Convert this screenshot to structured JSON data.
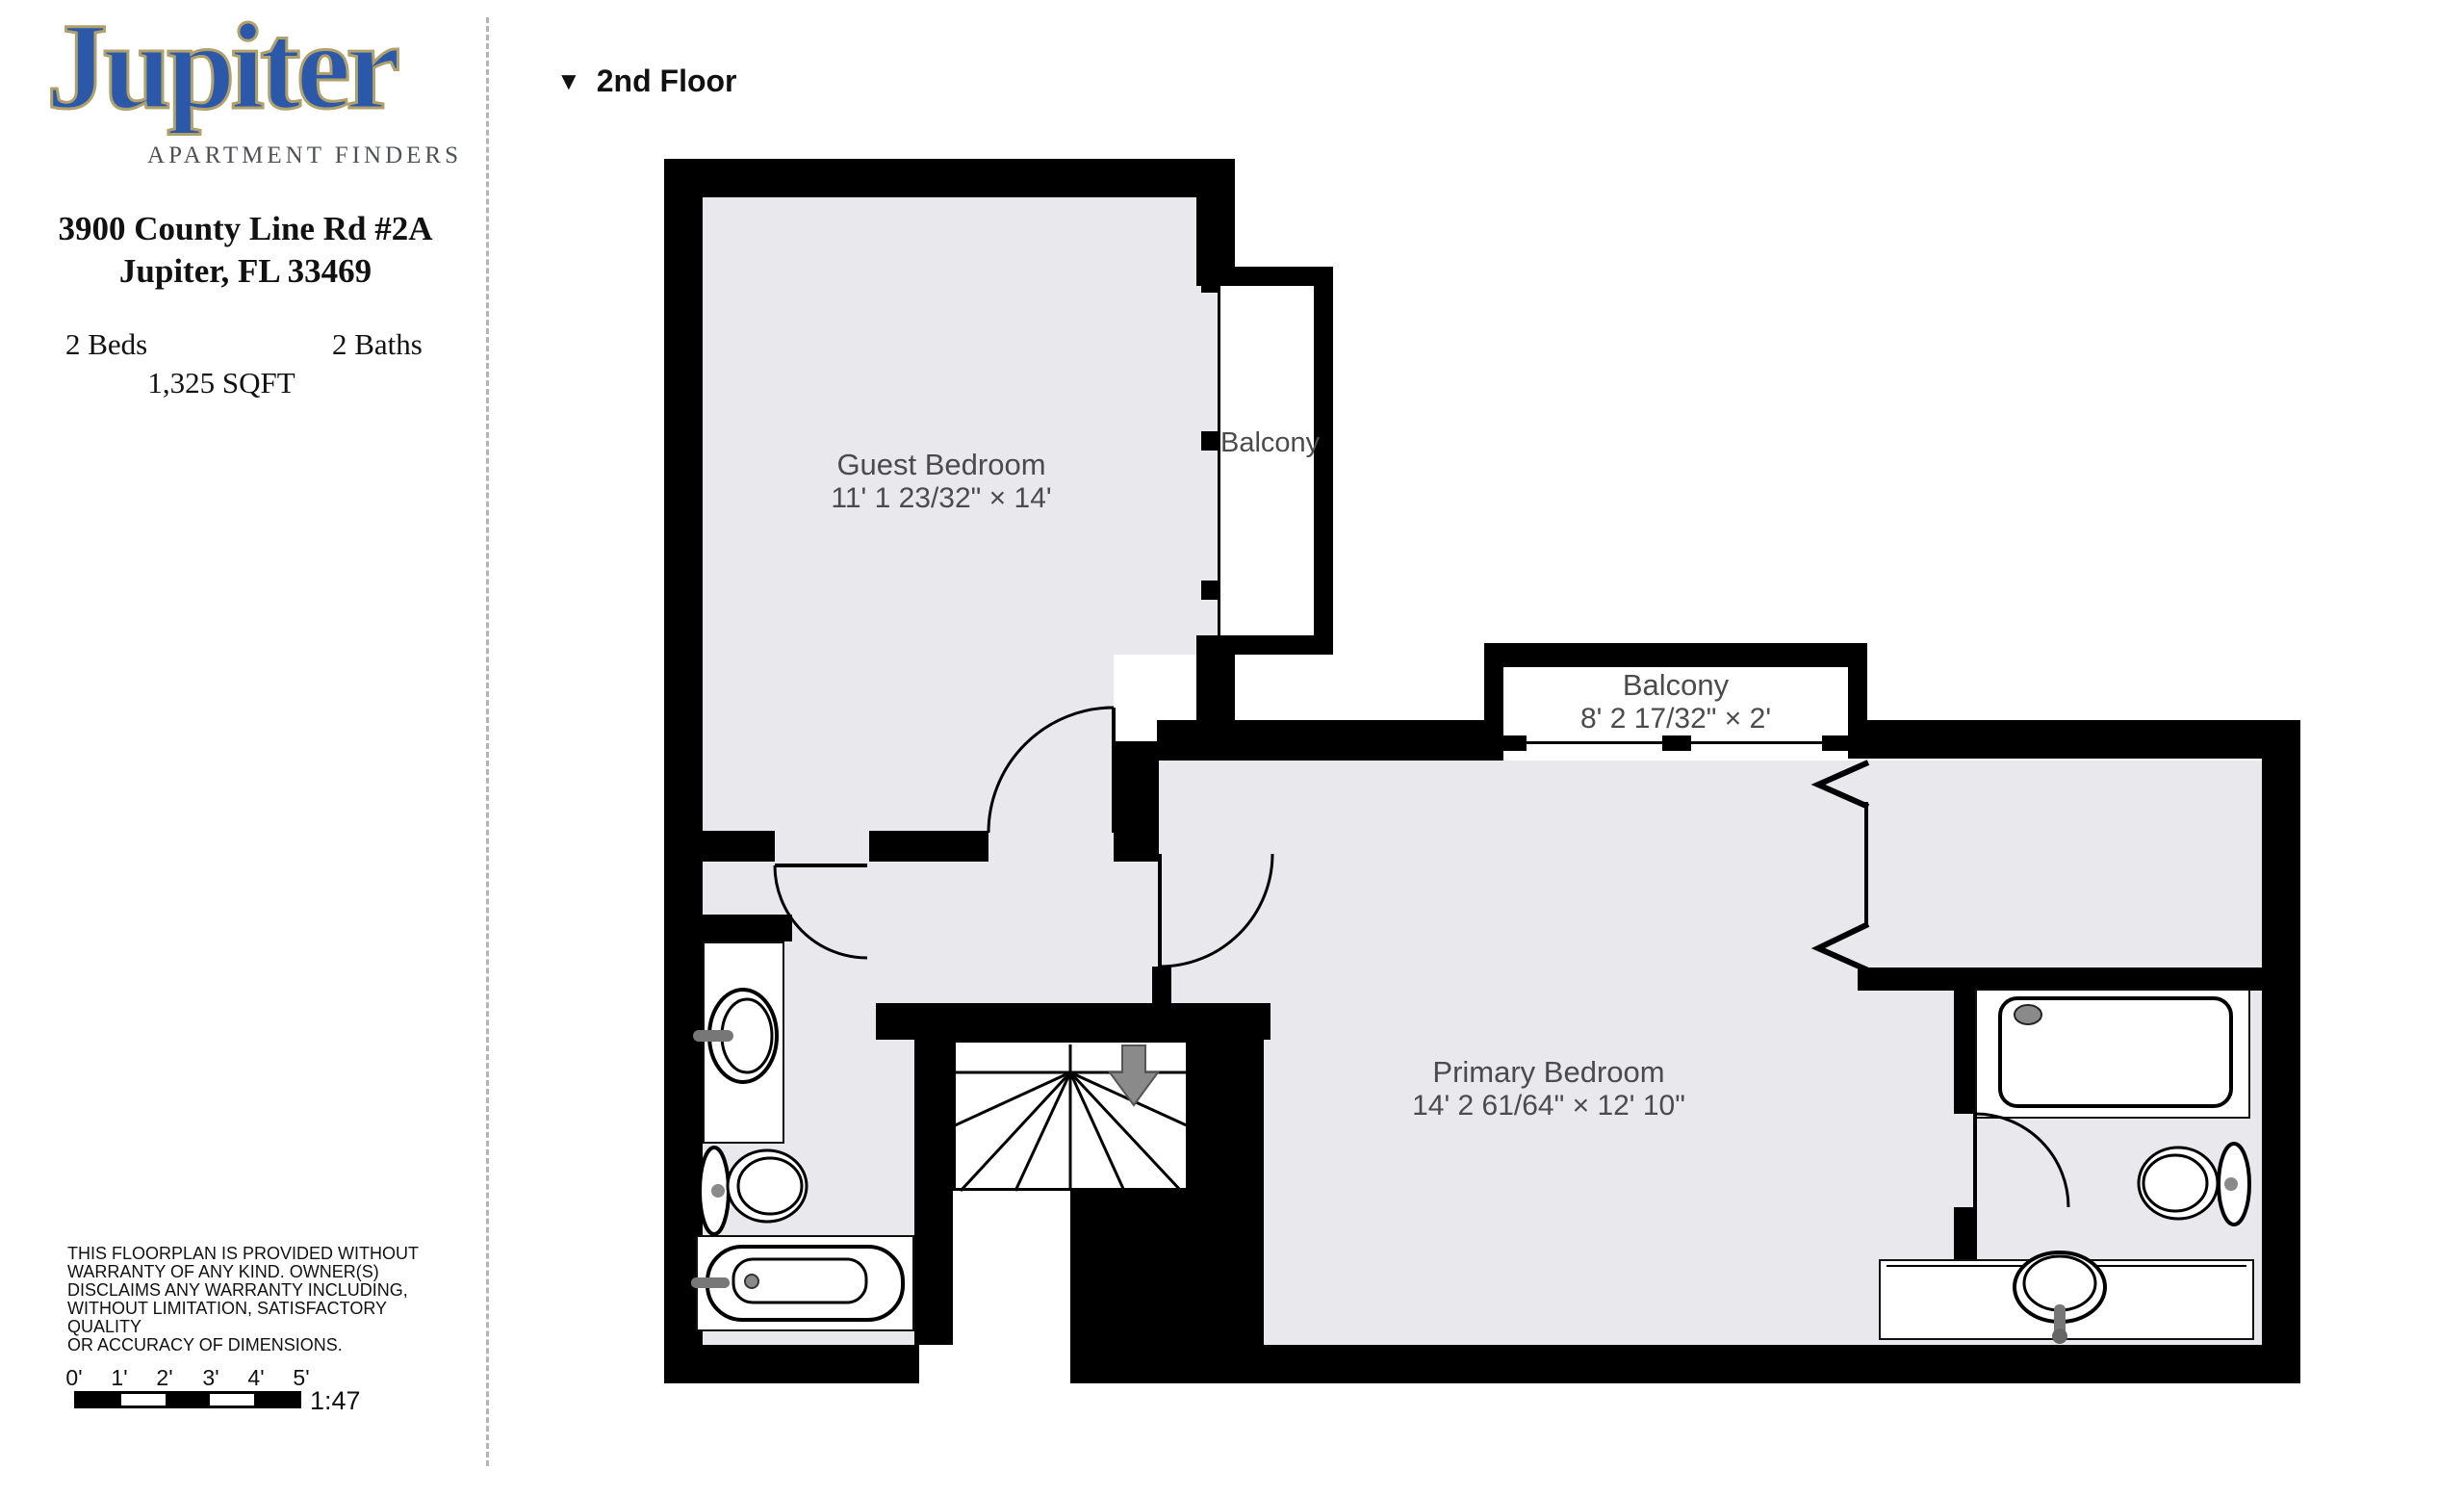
{
  "branding": {
    "logo_text": "Jupiter",
    "tagline": "APARTMENT FINDERS"
  },
  "listing": {
    "address_line1": "3900 County Line Rd #2A",
    "address_line2": "Jupiter, FL 33469",
    "beds": "2 Beds",
    "baths": "2 Baths",
    "area": "1,325 SQFT"
  },
  "floor_selector": {
    "marker": "▼",
    "label": "2nd Floor"
  },
  "rooms": {
    "guest_bedroom": {
      "name": "Guest Bedroom",
      "dims": "11' 1 23/32\" × 14'"
    },
    "side_balcony": {
      "name": "Balcony"
    },
    "center_balcony": {
      "name": "Balcony",
      "dims": "8' 2 17/32\" × 2'"
    },
    "primary_bedroom": {
      "name": "Primary Bedroom",
      "dims": "14' 2 61/64\" × 12' 10\""
    }
  },
  "disclaimer": {
    "lines": [
      "THIS FLOORPLAN IS PROVIDED WITHOUT",
      "WARRANTY OF ANY KIND. OWNER(S)",
      "DISCLAIMS ANY WARRANTY INCLUDING,",
      "WITHOUT LIMITATION, SATISFACTORY QUALITY",
      "OR ACCURACY OF DIMENSIONS."
    ]
  },
  "scale_bar": {
    "tick_labels": [
      "0'",
      "1'",
      "2'",
      "3'",
      "4'",
      "5'"
    ],
    "ratio": "1:47"
  },
  "colors": {
    "wall": "#000000",
    "room": "#e9e9ed",
    "logo_blue": "#2b58a8",
    "logo_tan": "#b0a06a",
    "label": "#4b4b4d",
    "arrow": "#8a8a8a"
  }
}
